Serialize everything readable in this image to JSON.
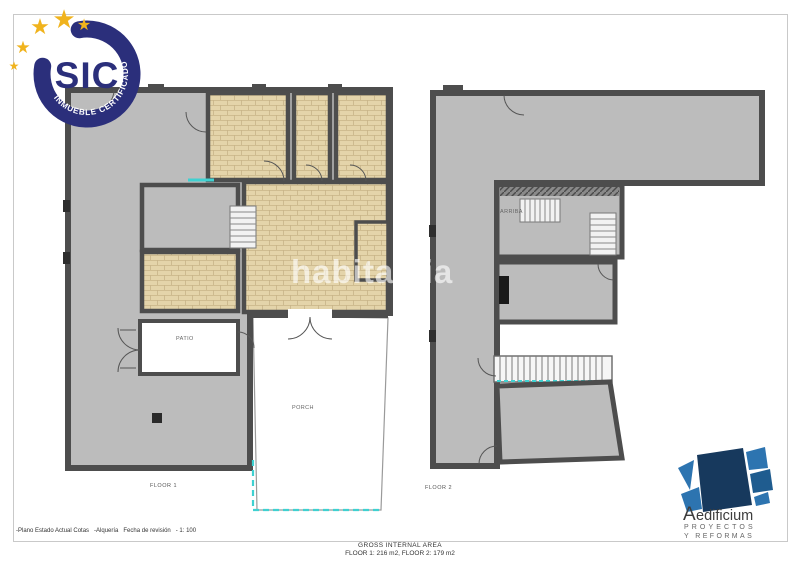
{
  "badge": {
    "name": "SIC",
    "arc_text": "INMUEBLE CERTIFICADO",
    "star_char": "★",
    "ring_color": "#2b2f7b",
    "star_color": "#f0b31d"
  },
  "watermark": {
    "text": "habitaclia"
  },
  "floor1": {
    "label": "FLOOR 1",
    "rooms": {
      "patio": "PATIO",
      "porch": "PORCH"
    }
  },
  "floor2": {
    "label": "FLOOR 2",
    "rooms": {
      "arriba": "ARRIBA"
    }
  },
  "footer": {
    "left_note": "-Plano Estado Actual Cotas   -Alquería   Fecha de revisión   - 1: 100",
    "area_title": "GROSS INTERNAL AREA",
    "area_detail": "FLOOR 1: 216 m2, FLOOR 2: 179 m2"
  },
  "logo": {
    "name_initial": "A",
    "name_rest": "edificium",
    "line1": "PROYECTOS",
    "line2": "Y REFORMAS",
    "navy": "#17395d",
    "blue": "#2d74b0"
  },
  "colors": {
    "wall": "#4d4d4d",
    "floor": "#bcbcbc",
    "tile": "#e4d4aa",
    "accent_cyan": "#3fd1d1"
  }
}
